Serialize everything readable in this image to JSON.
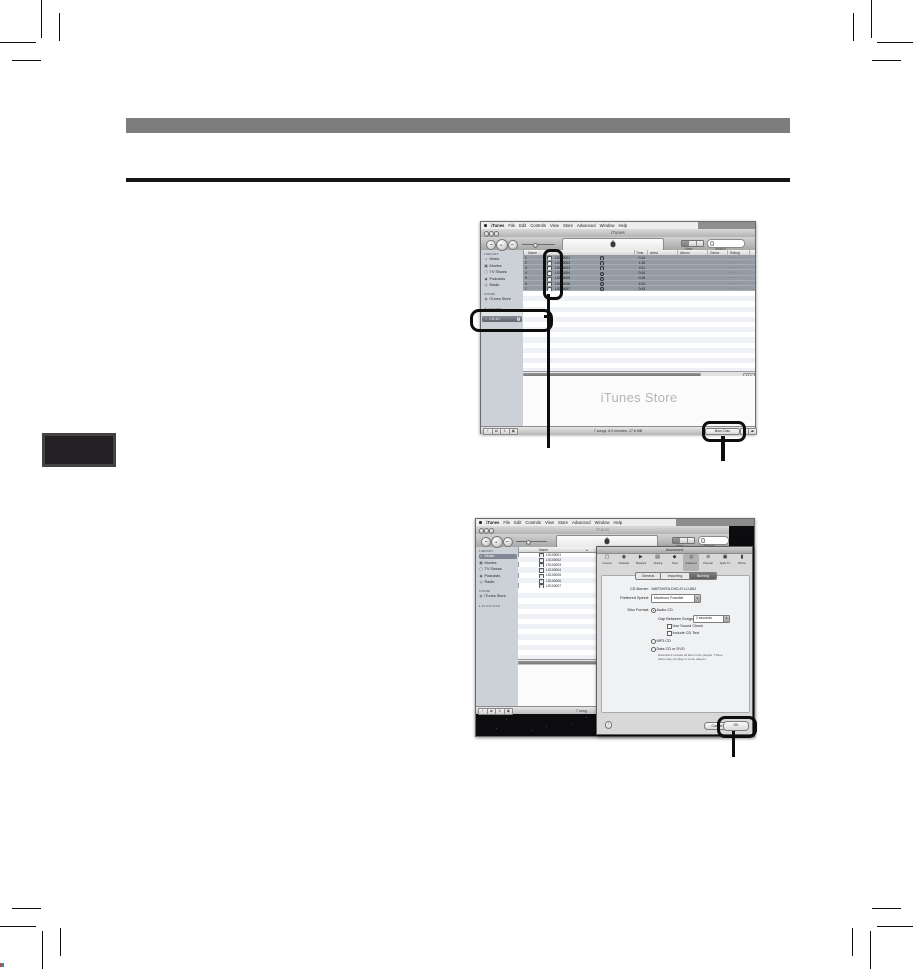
{
  "document": {
    "section_bar": "",
    "chapter_tab": ""
  },
  "colors": {
    "callout": "#0d0d0d",
    "selected_row": "#959ba4",
    "sidebar": "#ccd1d7"
  },
  "menu_bar": {
    "apple_icon": "apple-logo",
    "items": [
      "iTunes",
      "File",
      "Edit",
      "Controls",
      "View",
      "Store",
      "Advanced",
      "Window",
      "Help"
    ]
  },
  "columns": [
    "Name",
    "Time",
    "Artist",
    "Album",
    "Genre",
    "Rating"
  ],
  "sidebar": {
    "library_label": "LIBRARY",
    "library_items": [
      {
        "label": "Music",
        "icon": "♫"
      },
      {
        "label": "Movies",
        "icon": "▦"
      },
      {
        "label": "TV Shows",
        "icon": "▢"
      },
      {
        "label": "Podcasts",
        "icon": "◉"
      },
      {
        "label": "Radio",
        "icon": "◎"
      }
    ],
    "store_label": "STORE",
    "store_item": {
      "label": "iTunes Store",
      "icon": "◍"
    },
    "playlists_label": "PLAYLISTS",
    "playlists_label_collapsed": "▸ PLAYLISTS",
    "playlist_item": {
      "label": "LS-10",
      "icon": "♪",
      "speaker_icon": "◂"
    }
  },
  "tracks": [
    {
      "num": "1",
      "name": "LS100001",
      "time": "0:14",
      "checked": true
    },
    {
      "num": "2",
      "name": "LS100002",
      "time": "1:35",
      "checked": true
    },
    {
      "num": "3",
      "name": "LS100003",
      "time": "0:11",
      "checked": true
    },
    {
      "num": "4",
      "name": "LS100004",
      "time": "0:34",
      "checked": true
    },
    {
      "num": "5",
      "name": "LS100005",
      "time": "0:18",
      "checked": true
    },
    {
      "num": "6",
      "name": "LS100006",
      "time": "1:04",
      "checked": true
    },
    {
      "num": "7",
      "name": "LS100007",
      "time": "0:43",
      "checked": true
    }
  ],
  "rating_dots": "· · · · ·",
  "screenshot1": {
    "window_title": "iTunes",
    "view_label": "View",
    "search_label": "Search",
    "store_banner": "iTunes Store",
    "status_text": "7 songs, 6.9 minutes, 27.6 MB",
    "burn_disc_label": "Burn Disc",
    "status_buttons": [
      {
        "name": "add-playlist",
        "glyph": "+"
      },
      {
        "name": "shuffle",
        "glyph": "⇄"
      },
      {
        "name": "repeat",
        "glyph": "↻"
      },
      {
        "name": "show-artwork",
        "glyph": "▣"
      }
    ],
    "right_buttons": [
      {
        "name": "browse",
        "glyph": "▤"
      },
      {
        "name": "eject",
        "glyph": "⏏"
      }
    ],
    "transport": [
      {
        "name": "previous",
        "glyph": "◂◂"
      },
      {
        "name": "play",
        "glyph": "▸"
      },
      {
        "name": "next",
        "glyph": "▸▸"
      }
    ],
    "scroll_arrows": [
      "◂",
      "▸"
    ]
  },
  "screenshot2": {
    "window_title": "iTunes",
    "view_label": "View",
    "search_label": "Search",
    "name_column": "Name",
    "sort_icon": "▴",
    "status_text_partial": "7 song",
    "status_buttons": [
      {
        "name": "add-playlist",
        "glyph": "+"
      },
      {
        "name": "shuffle",
        "glyph": "⇄"
      },
      {
        "name": "repeat",
        "glyph": "↻"
      },
      {
        "name": "show-artwork",
        "glyph": "▣"
      }
    ],
    "transport": [
      {
        "name": "previous",
        "glyph": "◂◂"
      },
      {
        "name": "play",
        "glyph": "▸"
      },
      {
        "name": "next",
        "glyph": "▸▸"
      }
    ]
  },
  "dialog": {
    "title": "Advanced",
    "toolbar_icons": [
      {
        "label": "General",
        "glyph": "▢",
        "selected": false
      },
      {
        "label": "Podcasts",
        "glyph": "◉",
        "selected": false
      },
      {
        "label": "Playback",
        "glyph": "▶",
        "selected": false
      },
      {
        "label": "Sharing",
        "glyph": "▤",
        "selected": false
      },
      {
        "label": "Store",
        "glyph": "◆",
        "selected": false
      },
      {
        "label": "Advanced",
        "glyph": "◎",
        "selected": true
      },
      {
        "label": "Parental",
        "glyph": "⊘",
        "selected": false
      },
      {
        "label": "Apple TV",
        "glyph": "▣",
        "selected": false
      },
      {
        "label": "iPhone",
        "glyph": "▮",
        "selected": false
      }
    ],
    "tabs": [
      {
        "label": "General",
        "selected": false
      },
      {
        "label": "Importing",
        "selected": false
      },
      {
        "label": "Burning",
        "selected": true
      }
    ],
    "cd_burner_label": "CD Burner:",
    "cd_burner_value": "MATSHITA DVD-R   UJ-85J",
    "preferred_speed_label": "Preferred Speed:",
    "preferred_speed_value": "Maximum Possible",
    "disc_format_label": "Disc Format:",
    "audio_cd_label": "Audio CD",
    "gap_label": "Gap Between Songs:",
    "gap_value": "2 seconds",
    "sound_check_label": "Use Sound Check",
    "cd_text_label": "Include CD Text",
    "mp3_label": "MP3 CD",
    "data_cd_label": "Data CD or DVD",
    "data_note_line1": "Data discs include all files in the playlist. These",
    "data_note_line2": "discs may not play in some players.",
    "help_label": "?",
    "cancel_label": "Cancel",
    "ok_label": "OK",
    "stepper_icon": "⇅"
  }
}
